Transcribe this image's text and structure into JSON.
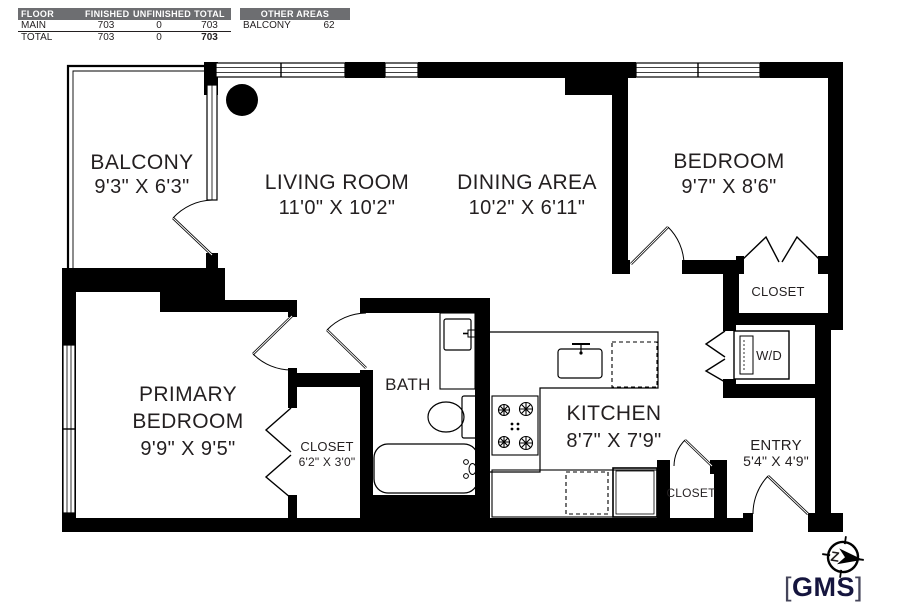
{
  "summary_table": {
    "headers": [
      "FLOOR",
      "FINISHED",
      "UNFINISHED",
      "TOTAL"
    ],
    "rows": [
      {
        "floor": "MAIN",
        "finished": "703",
        "unfinished": "0",
        "total": "703"
      },
      {
        "floor": "TOTAL",
        "finished": "703",
        "unfinished": "0",
        "total": "703"
      }
    ]
  },
  "other_areas_table": {
    "header": "OTHER AREAS",
    "rows": [
      {
        "name": "BALCONY",
        "area": "62"
      }
    ]
  },
  "rooms": {
    "balcony": {
      "name": "BALCONY",
      "dims": "9'3\" X 6'3\""
    },
    "living_room": {
      "name": "LIVING ROOM",
      "dims": "11'0\" X 10'2\""
    },
    "dining_area": {
      "name": "DINING AREA",
      "dims": "10'2\" X 6'11\""
    },
    "bedroom": {
      "name": "BEDROOM",
      "dims": "9'7\" X 8'6\""
    },
    "bedroom_closet": {
      "name": "CLOSET"
    },
    "washer_dryer": {
      "name": "W/D"
    },
    "primary_bedroom": {
      "name_line1": "PRIMARY",
      "name_line2": "BEDROOM",
      "dims": "9'9\" X 9'5\""
    },
    "primary_closet": {
      "name": "CLOSET",
      "dims": "6'2\" X 3'0\""
    },
    "bath": {
      "name": "BATH"
    },
    "kitchen": {
      "name": "KITCHEN",
      "dims": "8'7\" X 7'9\""
    },
    "entry_closet": {
      "name": "CLOSET"
    },
    "entry": {
      "name": "ENTRY",
      "dims": "5'4\" X 4'9\""
    }
  },
  "compass": {
    "letter": "Z"
  },
  "logo": {
    "bracket_left": "[",
    "text": "GMS",
    "bracket_right": "]"
  },
  "colors": {
    "wall": "#000000",
    "table_header_bg": "#6d6e71",
    "table_header_text": "#ffffff",
    "text": "#231f20",
    "logo_text": "#15153e",
    "logo_bracket": "#45455a"
  }
}
